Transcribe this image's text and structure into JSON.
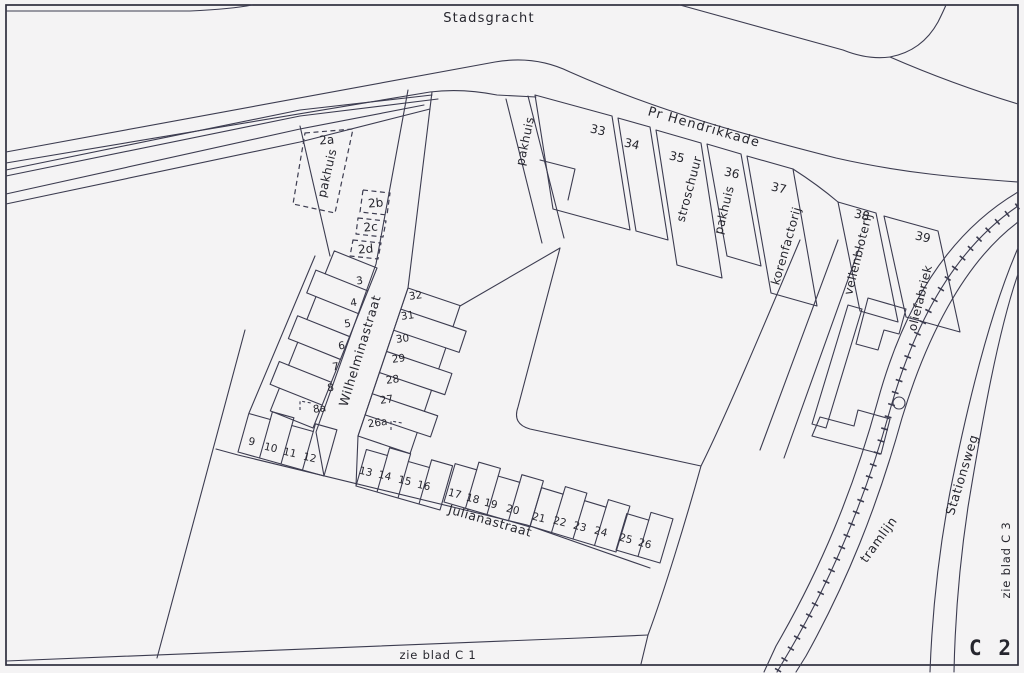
{
  "sheet": {
    "code": "C 2",
    "ref_south": "zie blad C 1",
    "ref_east": "zie blad C 3"
  },
  "streets": {
    "stadsgracht": "Stadsgracht",
    "pr_hendrikkade": "Pr Hendrikkade",
    "wilhelminastraat": "Wilhelminastraat",
    "julianastraat": "Julianastraat",
    "stationsweg": "Stationsweg",
    "tramlijn": "tramlijn"
  },
  "buildings": {
    "pakhuis_2a": "pakhuis",
    "pakhuis_lane": "pakhuis",
    "stroschuur": "stroschuur",
    "pakhuis_36": "pakhuis",
    "korenfactorij": "korenfactorij",
    "vellenbloterij": "vellenbloterij",
    "oliefabriek": "oliefabriek"
  },
  "parcel_numbers": [
    {
      "t": "2a",
      "x": 327,
      "y": 144,
      "r": -4
    },
    {
      "t": "2b",
      "x": 376,
      "y": 207,
      "r": -5
    },
    {
      "t": "2c",
      "x": 371,
      "y": 231,
      "r": -5
    },
    {
      "t": "2d",
      "x": 366,
      "y": 253,
      "r": -5
    },
    {
      "t": "33",
      "x": 597,
      "y": 134,
      "r": 13
    },
    {
      "t": "34",
      "x": 631,
      "y": 148,
      "r": 13
    },
    {
      "t": "35",
      "x": 676,
      "y": 161,
      "r": 13
    },
    {
      "t": "36",
      "x": 731,
      "y": 177,
      "r": 13
    },
    {
      "t": "37",
      "x": 778,
      "y": 192,
      "r": 13
    },
    {
      "t": "38",
      "x": 861,
      "y": 219,
      "r": 13
    },
    {
      "t": "39",
      "x": 922,
      "y": 241,
      "r": 13
    }
  ],
  "house_rows": [
    {
      "id": "wilhelminastraat-west",
      "front": [
        377,
        268,
        313,
        428
      ],
      "cells": 7,
      "depth": 46,
      "stagger": 10,
      "side": -1,
      "r": -8,
      "numbers": [
        [
          "3",
          360,
          284
        ],
        [
          "4",
          354,
          306
        ],
        [
          "5",
          348,
          327
        ],
        [
          "6",
          342,
          349
        ],
        [
          "7",
          336,
          370
        ],
        [
          "8",
          331,
          391
        ],
        [
          "8a",
          320,
          412
        ]
      ]
    },
    {
      "id": "wilhelminastraat-east",
      "front": [
        408,
        288,
        358,
        436
      ],
      "cells": 7,
      "depth": 55,
      "stagger": 14,
      "side": 1,
      "r": -8,
      "numbers": [
        [
          "32",
          416,
          299
        ],
        [
          "31",
          408,
          319
        ],
        [
          "30",
          403,
          342
        ],
        [
          "29",
          399,
          362
        ],
        [
          "28",
          393,
          383
        ],
        [
          "27",
          387,
          403
        ],
        [
          "26a",
          378,
          426
        ]
      ]
    },
    {
      "id": "julianastraat-9-12",
      "front": [
        238,
        452,
        324,
        476
      ],
      "cells": 4,
      "depth": 40,
      "stagger": 8,
      "side": 1,
      "r": 13,
      "numbers": [
        [
          "9",
          251,
          445
        ],
        [
          "10",
          270,
          451
        ],
        [
          "11",
          289,
          456
        ],
        [
          "12",
          309,
          461
        ]
      ]
    },
    {
      "id": "julianastraat-13-16",
      "front": [
        356,
        486,
        440,
        510
      ],
      "cells": 4,
      "depth": 38,
      "stagger": 8,
      "side": 1,
      "r": 13,
      "numbers": [
        [
          "13",
          365,
          475
        ],
        [
          "14",
          384,
          479
        ],
        [
          "15",
          404,
          484
        ],
        [
          "16",
          423,
          489
        ]
      ]
    },
    {
      "id": "julianastraat-17-20",
      "front": [
        444,
        502,
        530,
        527
      ],
      "cells": 4,
      "depth": 40,
      "stagger": 8,
      "side": 1,
      "r": 14,
      "numbers": [
        [
          "17",
          454,
          497
        ],
        [
          "18",
          472,
          502
        ],
        [
          "19",
          490,
          507
        ],
        [
          "20",
          512,
          513
        ]
      ]
    },
    {
      "id": "julianastraat-21-24",
      "front": [
        530,
        526,
        616,
        552
      ],
      "cells": 4,
      "depth": 40,
      "stagger": 8,
      "side": 1,
      "r": 14,
      "numbers": [
        [
          "21",
          538,
          521
        ],
        [
          "22",
          559,
          525
        ],
        [
          "23",
          579,
          530
        ],
        [
          "24",
          600,
          535
        ]
      ]
    },
    {
      "id": "julianastraat-25-26",
      "front": [
        616,
        550,
        660,
        563
      ],
      "cells": 2,
      "depth": 38,
      "stagger": 8,
      "side": 1,
      "r": 14,
      "numbers": [
        [
          "25",
          625,
          542
        ],
        [
          "26",
          644,
          547
        ]
      ]
    }
  ]
}
